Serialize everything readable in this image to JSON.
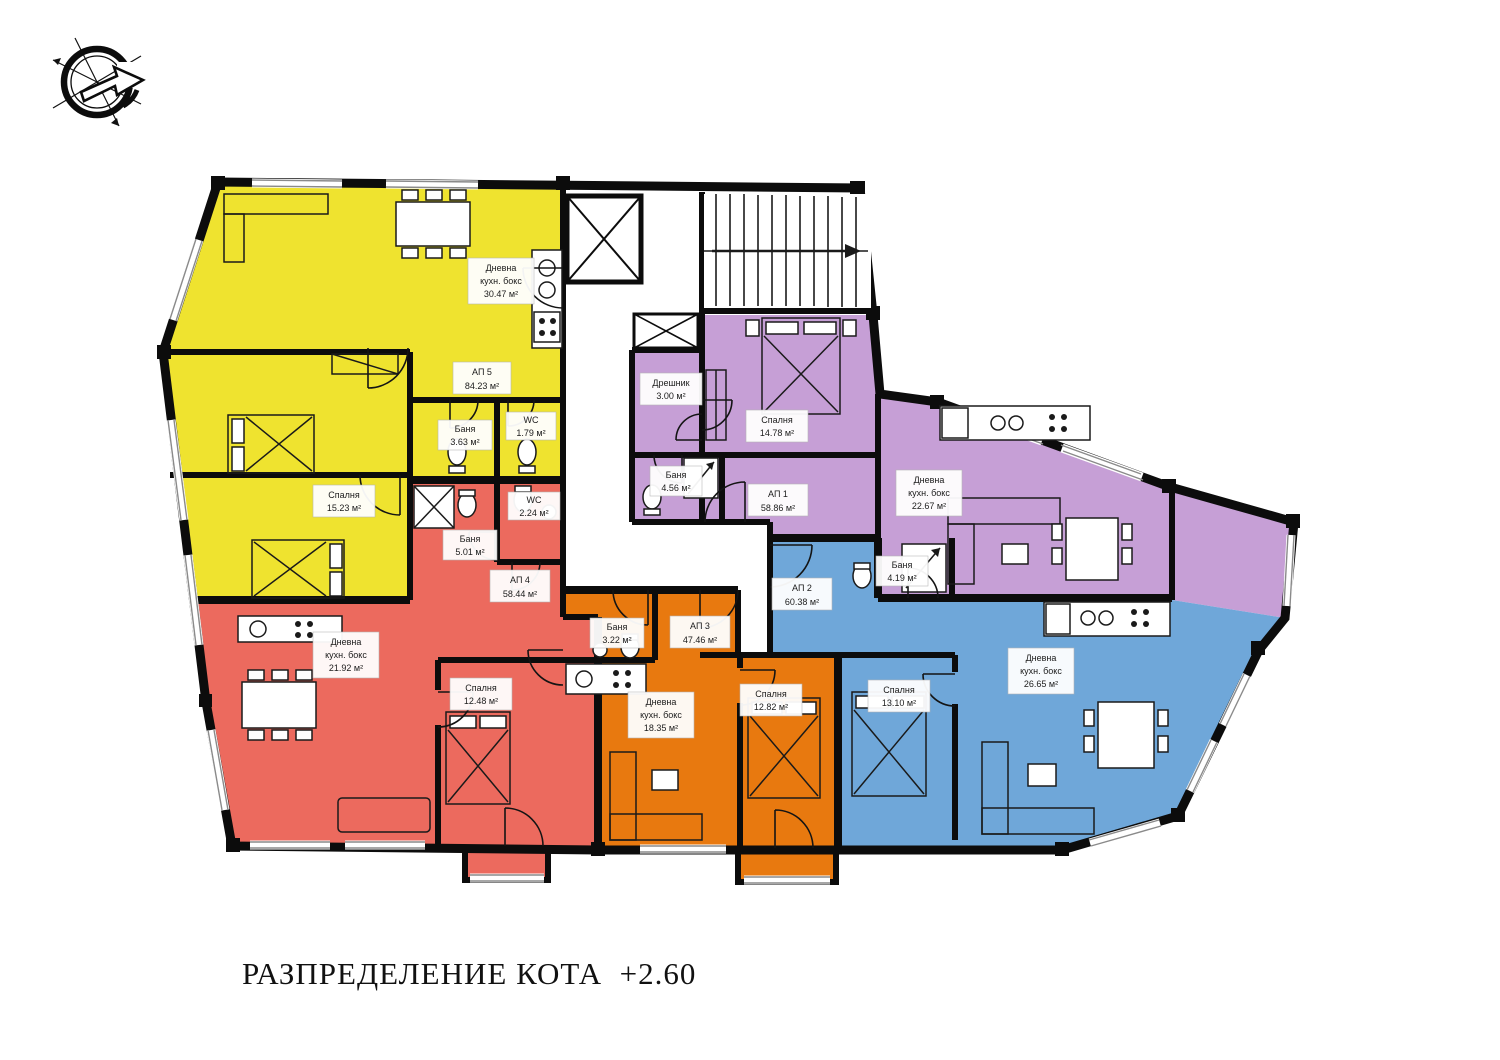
{
  "title": "РАЗПРЕДЕЛЕНИЕ КОТА  +2.60",
  "compass": {
    "icon": "north-arrow"
  },
  "apartments": [
    {
      "id": "АП 5",
      "area": "84.23 м²",
      "color": "#efe32f",
      "rooms": [
        {
          "name": "Дневна",
          "sub": "кухн. бокс",
          "area": "30.47 м²"
        },
        {
          "name": "Спалня",
          "area": "15.23 м²"
        },
        {
          "name": "Баня",
          "area": "3.63 м²"
        },
        {
          "name": "WC",
          "area": "1.79 м²"
        }
      ]
    },
    {
      "id": "АП 4",
      "area": "58.44 м²",
      "color": "#ec6a5e",
      "rooms": [
        {
          "name": "Баня",
          "area": "5.01 м²"
        },
        {
          "name": "WC",
          "area": "2.24 м²"
        },
        {
          "name": "Дневна",
          "sub": "кухн. бокс",
          "area": "21.92 м²"
        },
        {
          "name": "Спалня",
          "area": "12.48 м²"
        }
      ]
    },
    {
      "id": "АП 3",
      "area": "47.46 м²",
      "color": "#e8790f",
      "rooms": [
        {
          "name": "Баня",
          "area": "3.22 м²"
        },
        {
          "name": "Дневна",
          "sub": "кухн. бокс",
          "area": "18.35 м²"
        },
        {
          "name": "Спалня",
          "area": "12.82 м²"
        }
      ]
    },
    {
      "id": "АП 1",
      "area": "58.86 м²",
      "color": "#c69fd6",
      "rooms": [
        {
          "name": "Дрешник",
          "area": "3.00 м²"
        },
        {
          "name": "Спалня",
          "area": "14.78 м²"
        },
        {
          "name": "Баня",
          "area": "4.56 м²"
        },
        {
          "name": "Дневна",
          "sub": "кухн. бокс",
          "area": "22.67 м²"
        }
      ]
    },
    {
      "id": "АП 2",
      "area": "60.38 м²",
      "color": "#6fa7d9",
      "rooms": [
        {
          "name": "Баня",
          "area": "4.19 м²"
        },
        {
          "name": "Спалня",
          "area": "13.10 м²"
        },
        {
          "name": "Дневна",
          "sub": "кухн. бокс",
          "area": "26.65 м²"
        }
      ]
    }
  ]
}
